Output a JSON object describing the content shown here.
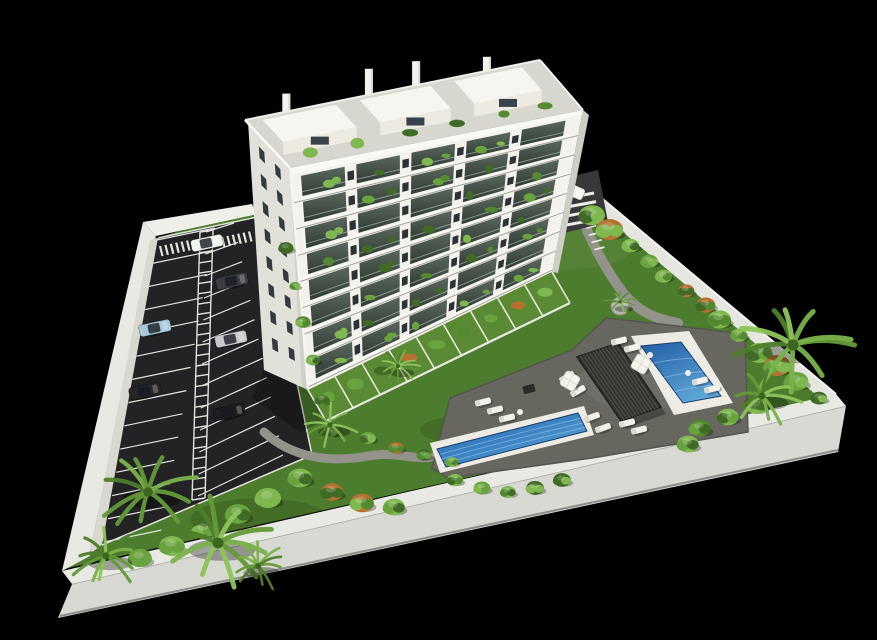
{
  "image": {
    "width": 877,
    "height": 640,
    "background": "#000000",
    "description": "Aerial 3D architectural render: white apartment tower with plant-filled balconies, parking lot with cars, lawns, pool deck with two blue pools, pergola, sun loungers and palm trees inside a white perimeter wall on black"
  },
  "palette": {
    "background": "#000000",
    "lawn": "#4c7c2d",
    "lawnBright": "#578a34",
    "wallTop": "#e9e9e3",
    "wallFace": "#d9d9d3",
    "wallInnerShade": "rgba(0,0,0,0.18)",
    "asphalt": "#232325",
    "curb": "#d8d8d1",
    "marking": "#e3e3de",
    "walkway": "#7e7e77",
    "path": "#93928b",
    "entranceDrive": "#38383a",
    "deck": "#67665f",
    "deckEdge": "#55544e",
    "building": "#f3f2ec",
    "buildingShade": "#e2e1d9",
    "slab": "#f8f8f3",
    "roof": "#d7d6cf",
    "penthouse": "#f6f6f1",
    "penthouseFace": "#eceae1",
    "windowDark": "#2c3236",
    "sideWindow": "#343a3e",
    "glassTop": "#5a675e",
    "glassBottom": "#2f3a33",
    "poolLight": "#6fb3de",
    "poolDark": "#1d4f92",
    "coping": "#edebe3",
    "ripple": "#9ed1ee",
    "pergola": "#32312d",
    "pergolaSlat": "#504f47",
    "lounger": "#f2f1ea",
    "greens": [
      "#3f6b26",
      "#538a30",
      "#68a33e",
      "#7fb84e"
    ],
    "palmGreens": [
      "#4e7d2a",
      "#639a38",
      "#79b24a",
      "#8cc45a"
    ],
    "accentBush": "#b5712f"
  },
  "scene": {
    "site": {
      "lawn": [
        [
          150,
          240
        ],
        [
          255,
          208
        ],
        [
          568,
          172
        ],
        [
          836,
          394
        ],
        [
          64,
          569
        ]
      ]
    },
    "lawn_patches": [
      [
        420,
        310,
        70,
        24
      ],
      [
        680,
        370,
        55,
        20
      ],
      [
        520,
        515,
        85,
        24
      ],
      [
        260,
        520,
        70,
        22
      ],
      [
        360,
        300,
        50,
        18
      ],
      [
        480,
        430,
        60,
        16
      ]
    ],
    "walls": {
      "left": [
        [
          143,
          222
        ],
        [
          156,
          236
        ],
        [
          90,
          556
        ],
        [
          62,
          571
        ]
      ],
      "top": [
        [
          143,
          222
        ],
        [
          252,
          204
        ],
        [
          258,
          214
        ],
        [
          156,
          236
        ]
      ],
      "right": [
        [
          568,
          170
        ],
        [
          836,
          394
        ],
        [
          827,
          404
        ],
        [
          561,
          180
        ]
      ],
      "bottom_top": [
        [
          62,
          571
        ],
        [
          836,
          394
        ],
        [
          846,
          406
        ],
        [
          72,
          584
        ]
      ],
      "bottom_face": [
        [
          72,
          584
        ],
        [
          846,
          406
        ],
        [
          838,
          452
        ],
        [
          58,
          618
        ]
      ]
    },
    "parking": {
      "curb": [
        [
          150,
          240
        ],
        [
          158,
          238
        ],
        [
          104,
          543
        ],
        [
          90,
          554
        ]
      ],
      "asphalt": [
        [
          158,
          238
        ],
        [
          262,
          216
        ],
        [
          312,
          455
        ],
        [
          102,
          545
        ]
      ],
      "stalls_left": {
        "edge_a": [
          157,
          240
        ],
        "edge_b": [
          104,
          542
        ],
        "dir": [
          58,
          -12
        ],
        "count": 14
      },
      "stalls_right": {
        "inner_a": [
          206,
          232
        ],
        "inner_b": [
          198,
          496
        ],
        "outer_a": [
          234,
          223
        ],
        "outer_b": [
          283,
          455
        ],
        "count": 13
      },
      "walkway_rails": {
        "left": [
          [
            200,
            232
          ],
          [
            192,
            500
          ]
        ],
        "right": [
          [
            213,
            230
          ],
          [
            205,
            498
          ]
        ],
        "rungs": 26
      },
      "crossings": [
        [
          160,
          246
        ],
        [
          222,
          237
        ]
      ],
      "cars": [
        {
          "x": 155,
          "y": 328,
          "angle": -12,
          "color": "#a8c8dc",
          "name": "light-blue-parked"
        },
        {
          "x": 145,
          "y": 391,
          "angle": -12,
          "color": "#26262a",
          "name": "black-parked"
        },
        {
          "x": 232,
          "y": 281,
          "angle": -12,
          "color": "#3c3c42",
          "name": "dark-gray-parked"
        },
        {
          "x": 231,
          "y": 339,
          "angle": -12,
          "color": "#c9c9cd",
          "name": "silver-parked"
        },
        {
          "x": 229,
          "y": 412,
          "angle": -12,
          "color": "#1e1e22",
          "name": "black-parked-2"
        },
        {
          "x": 207,
          "y": 243,
          "angle": -12,
          "color": "#f2f2ee",
          "name": "white-driving"
        },
        {
          "x": 569,
          "y": 189,
          "angle": 24,
          "color": "#f4f4f0",
          "name": "white-at-entrance"
        }
      ]
    },
    "side_strip": [
      [
        252,
        206
      ],
      [
        290,
        170
      ],
      [
        312,
        392
      ],
      [
        330,
        444
      ],
      [
        262,
        216
      ]
    ],
    "strip_bushes": [
      [
        286,
        248
      ],
      [
        295,
        286
      ],
      [
        303,
        322
      ],
      [
        313,
        360
      ],
      [
        322,
        400
      ],
      [
        331,
        432
      ]
    ],
    "building": {
      "floors": 8,
      "bays": 5,
      "side": [
        [
          248,
          122
        ],
        [
          290,
          168
        ],
        [
          308,
          390
        ],
        [
          264,
          370
        ]
      ],
      "facade": [
        [
          290,
          168
        ],
        [
          583,
          110
        ],
        [
          552,
          272
        ],
        [
          308,
          390
        ]
      ],
      "roof": [
        [
          245,
          120
        ],
        [
          540,
          60
        ],
        [
          583,
          110
        ],
        [
          290,
          168
        ]
      ],
      "side_window_cols": [
        0.3,
        0.68
      ],
      "side_window_rows": 8,
      "pier_centers": [
        0.205,
        0.395,
        0.585,
        0.775
      ],
      "chimneys": [
        [
          0.14,
          18
        ],
        [
          0.42,
          26
        ],
        [
          0.58,
          24
        ],
        [
          0.82,
          14
        ]
      ],
      "penthouses": [
        [
          0.05,
          0.3
        ],
        [
          0.38,
          0.62
        ],
        [
          0.7,
          0.93
        ]
      ],
      "roof_plants": [
        0.1,
        0.26,
        0.44,
        0.6,
        0.76,
        0.9
      ],
      "shadow": [
        [
          264,
          370
        ],
        [
          308,
          390
        ],
        [
          326,
          420
        ],
        [
          300,
          432
        ],
        [
          252,
          398
        ]
      ]
    },
    "terraces": {
      "base_a": [
        308,
        390
      ],
      "base_b": [
        552,
        272
      ],
      "offset": [
        18,
        31
      ],
      "fences": 9
    },
    "terrace_shrubs": [
      [
        368,
        438
      ],
      [
        396,
        448
      ],
      [
        424,
        455
      ],
      [
        452,
        462
      ]
    ],
    "paths": {
      "a": "M 578,208 C 590,240 604,268 624,294 C 640,313 656,319 678,323",
      "b": "M 264,432 C 292,458 330,463 368,456 C 398,450 420,464 444,454",
      "steps_origin": [
        586,
        228
      ],
      "steps_step": [
        2.8,
        7.2
      ],
      "steps_bar": [
        10,
        -2.5
      ],
      "steps_count": 4
    },
    "entrance": {
      "pad": [
        [
          548,
          182
        ],
        [
          598,
          170
        ],
        [
          608,
          222
        ],
        [
          560,
          234
        ]
      ],
      "zebra_origin": [
        556,
        200
      ],
      "zebra_step": [
        2,
        8.6
      ],
      "zebra_bar": [
        38,
        -7
      ],
      "zebra_count": 4
    },
    "deck": [
      [
        432,
        468
      ],
      [
        450,
        398
      ],
      [
        572,
        350
      ],
      [
        606,
        318
      ],
      [
        660,
        324
      ],
      [
        745,
        334
      ],
      [
        748,
        432
      ],
      [
        592,
        458
      ],
      [
        448,
        478
      ]
    ],
    "pergola": {
      "quad": [
        [
          577,
          357
        ],
        [
          618,
          343
        ],
        [
          661,
          407
        ],
        [
          621,
          421
        ]
      ],
      "slats": 13
    },
    "pools": {
      "large": {
        "coping": [
          [
            430,
            443
          ],
          [
            584,
            406
          ],
          [
            594,
            435
          ],
          [
            440,
            473
          ]
        ],
        "water": [
          [
            437,
            449
          ],
          [
            578,
            413
          ],
          [
            587,
            431
          ],
          [
            446,
            467
          ]
        ]
      },
      "small": {
        "coping": [
          [
            631,
            336
          ],
          [
            689,
            331
          ],
          [
            733,
            403
          ],
          [
            674,
            415
          ]
        ],
        "water": [
          [
            641,
            346
          ],
          [
            681,
            342
          ],
          [
            721,
            396
          ],
          [
            683,
            403
          ]
        ]
      }
    },
    "loungers": [
      [
        483,
        402,
        -14
      ],
      [
        495,
        410,
        -14
      ],
      [
        507,
        418,
        -14
      ],
      [
        567,
        377,
        -30
      ],
      [
        578,
        391,
        -30
      ],
      [
        592,
        417,
        -20
      ],
      [
        603,
        428,
        -20
      ],
      [
        619,
        341,
        -14
      ],
      [
        632,
        348,
        -14
      ],
      [
        627,
        423,
        -14
      ],
      [
        639,
        430,
        -14
      ],
      [
        700,
        381,
        -14
      ],
      [
        712,
        389,
        -14
      ]
    ],
    "umbrellas": [
      [
        570,
        381
      ],
      [
        641,
        364
      ]
    ],
    "tables": [
      [
        520,
        412
      ],
      [
        650,
        355
      ],
      [
        688,
        373
      ]
    ],
    "firepit": [
      529,
      389
    ],
    "planter": {
      "x": 620,
      "y": 306,
      "r": 9
    },
    "wall_trees": {
      "from": [
        592,
        206
      ],
      "to": [
        818,
        390
      ],
      "count": 13
    },
    "shrub_groups": {
      "below_pool": [
        [
          455,
          480
        ],
        [
          482,
          488
        ],
        [
          508,
          492
        ],
        [
          535,
          488
        ],
        [
          562,
          480
        ]
      ],
      "right_corner": [
        [
          700,
          428
        ],
        [
          728,
          417
        ],
        [
          757,
          406
        ],
        [
          688,
          444
        ]
      ],
      "bottom_left": [
        [
          300,
          478
        ],
        [
          332,
          492
        ],
        [
          362,
          503
        ],
        [
          394,
          507
        ],
        [
          268,
          498
        ],
        [
          238,
          514
        ],
        [
          204,
          530
        ],
        [
          172,
          546
        ],
        [
          140,
          558
        ]
      ]
    },
    "palms": [
      [
        793,
        345,
        56
      ],
      [
        762,
        396,
        36
      ],
      [
        148,
        492,
        48
      ],
      [
        218,
        543,
        54
      ],
      [
        106,
        556,
        36
      ],
      [
        258,
        566,
        30
      ],
      [
        330,
        425,
        26
      ],
      [
        398,
        366,
        20
      ],
      [
        620,
        302,
        15
      ]
    ]
  }
}
